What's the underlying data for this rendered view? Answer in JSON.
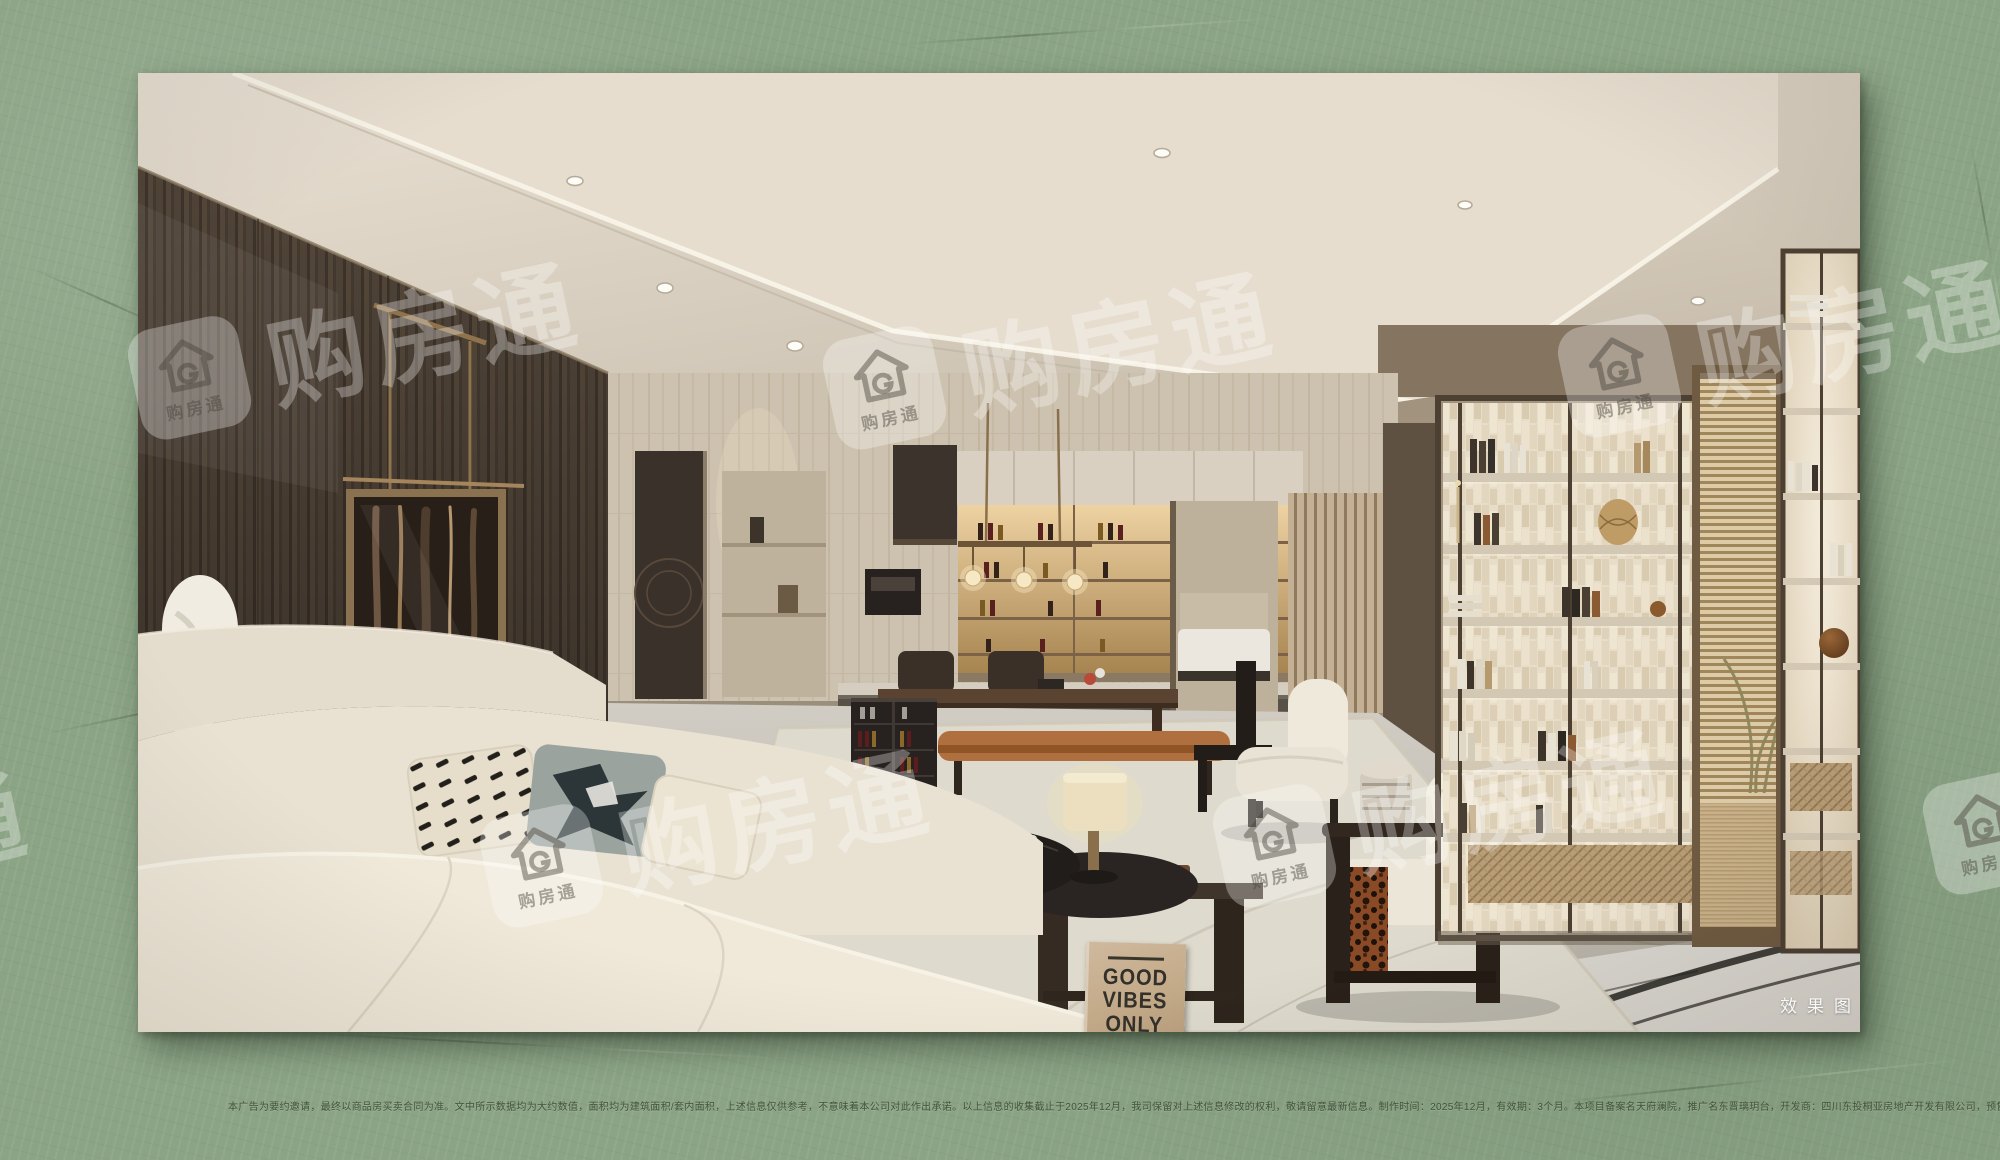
{
  "page": {
    "background_color": "#8ca486",
    "photo_label": "效果图"
  },
  "watermark": {
    "brand": "购房通",
    "badge_label": "购房通",
    "color": "#ffffff"
  },
  "good_vibes_sign": {
    "lines": [
      "GOOD",
      "VIBES",
      "ONLY"
    ]
  },
  "disclaimer": "本广告为要约邀请，最终以商品房买卖合同为准。文中所示数据均为大约数值，面积均为建筑面积/套内面积，上述信息仅供参考，不意味着本公司对此作出承诺。以上信息的收集截止于2025年12月，我司保留对上述信息修改的权利，敬请留意最新信息。制作时间：2025年12月，有效期：3个月。本项目备案名天府澜院，推广名东晋璃玥台，开发商：四川东投桐亚房地产开发有限公司，预售许可证：510118202580465，图片仅供示意，非交付标准。"
}
